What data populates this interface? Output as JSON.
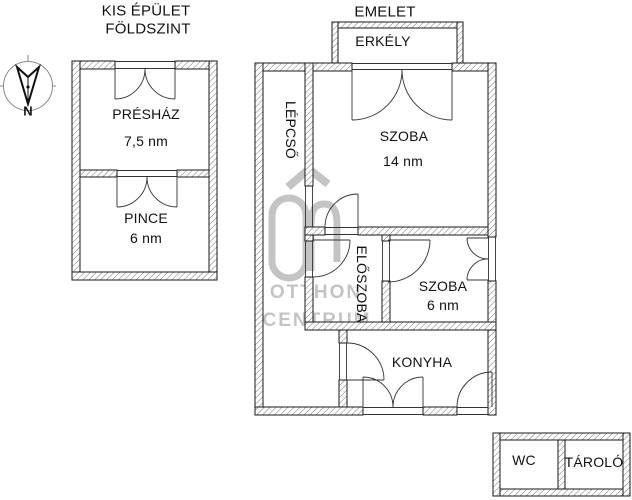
{
  "titles": {
    "small_building_line1": "KIS ÉPÜLET",
    "small_building_line2": "FÖLDSZINT",
    "main_building": "EMELET"
  },
  "compass": {
    "north": "N"
  },
  "floorplan": {
    "ground_floor_rooms": [
      {
        "name": "PRÉSHÁZ",
        "area": "7,5 nm"
      },
      {
        "name": "PINCE",
        "area": "6 nm"
      }
    ],
    "upper_floor": {
      "balcony": "ERKÉLY",
      "stairs": "LÉPCSŐ",
      "hall": "ELŐSZOBA",
      "rooms": [
        {
          "name": "SZOBA",
          "area": "14 nm"
        },
        {
          "name": "SZOBA",
          "area": "6 nm"
        },
        {
          "name": "KONYHA",
          "area": ""
        }
      ]
    },
    "outbuilding_rooms": [
      {
        "name": "WC"
      },
      {
        "name": "TÁROLÓ"
      }
    ]
  },
  "watermark": {
    "line1": "OTTHON",
    "line2": "CENTRUM"
  },
  "colors": {
    "line": "#1a1a1a",
    "watermark": "#c4c4c4",
    "hatch": "#555555"
  }
}
